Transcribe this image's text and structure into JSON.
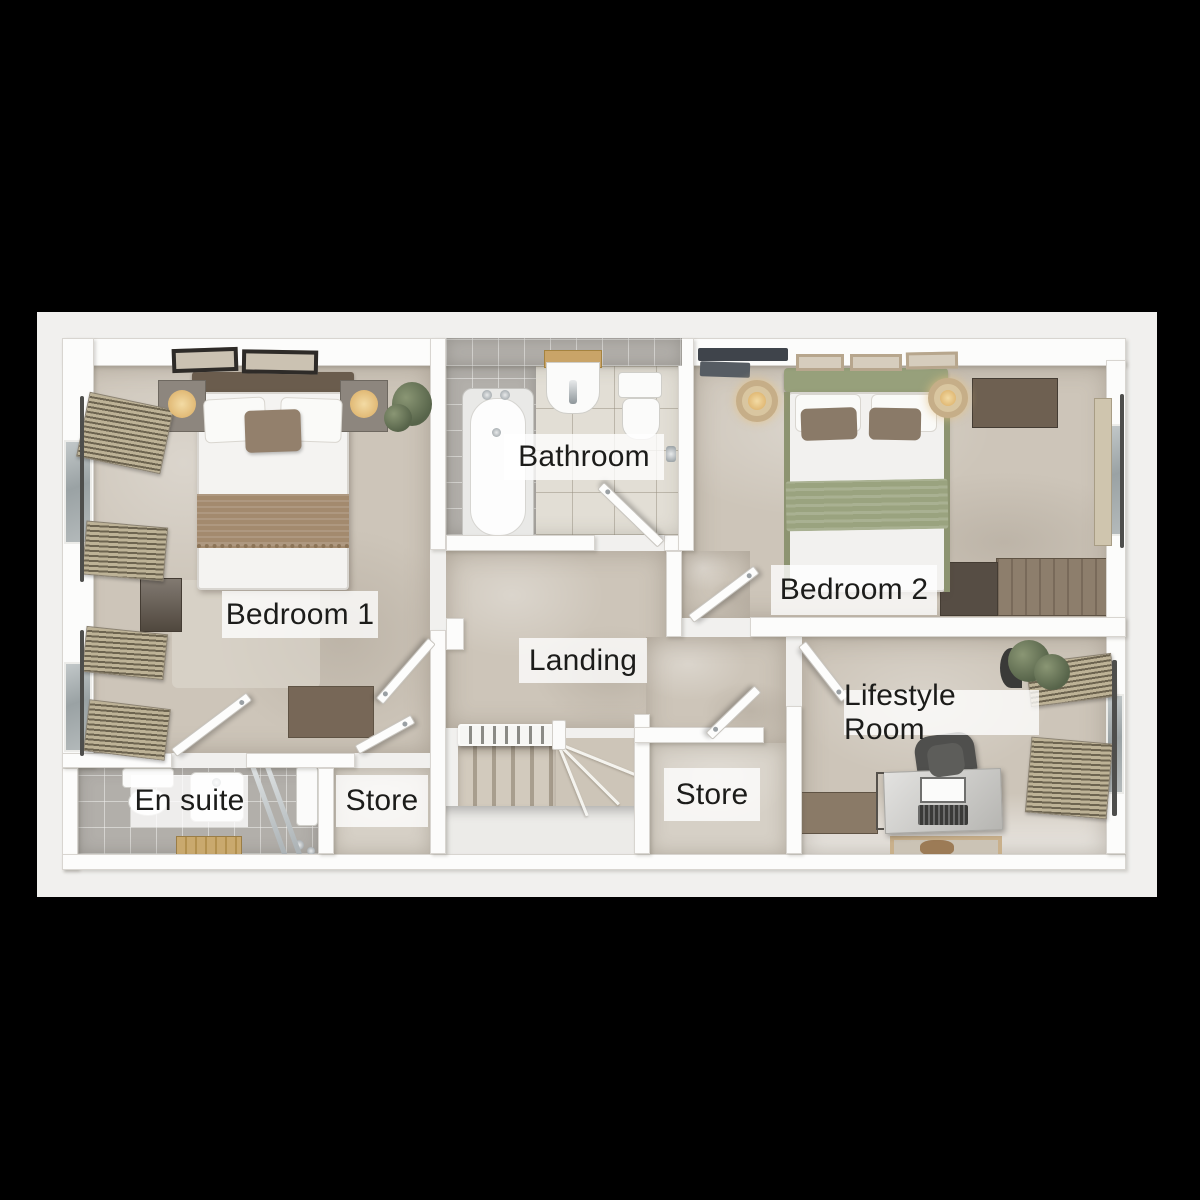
{
  "plan": {
    "type": "floor-plan",
    "floor_label": null
  },
  "rooms": [
    {
      "id": "bedroom-1",
      "label": "Bedroom 1"
    },
    {
      "id": "bathroom",
      "label": "Bathroom"
    },
    {
      "id": "bedroom-2",
      "label": "Bedroom 2"
    },
    {
      "id": "landing",
      "label": "Landing"
    },
    {
      "id": "store-center",
      "label": "Store"
    },
    {
      "id": "lifestyle-room",
      "label": "Lifestyle Room"
    },
    {
      "id": "en-suite",
      "label": "En suite"
    },
    {
      "id": "store-left",
      "label": "Store"
    }
  ],
  "colors": {
    "background": "#000000",
    "page": "#f1f0ee",
    "wall": "#fcfcfb",
    "wall_edge": "#d8d5d0",
    "carpet": "#cdc5b9",
    "carpet_light": "#d6d0c6",
    "tile_light": "#e2ded5",
    "tile_gray": "#b2afaa",
    "sage_green": "#97a07b",
    "wood_brown": "#8d7e6c",
    "label_background": "rgba(255,255,255,0.78)",
    "label_text": "#1c1c1a"
  }
}
